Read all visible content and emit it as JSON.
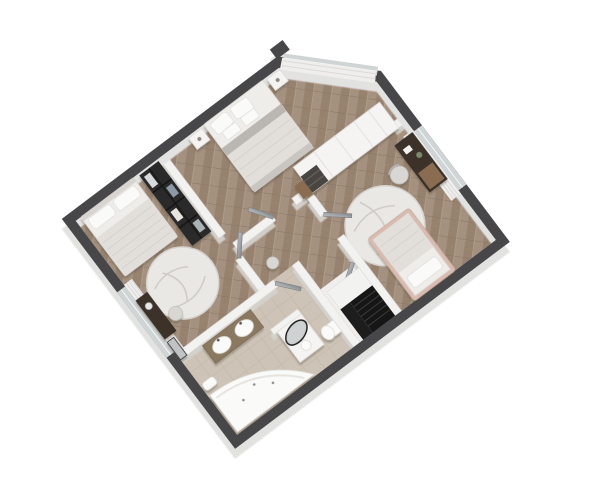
{
  "scene": {
    "type": "3d-floorplan-render",
    "description": "Isometric 3D render of an apartment upper floor on a white background, rotated about 37 degrees, dark grey wall tops, herringbone wood flooring, beige tiled bathroom",
    "rotation_deg": -37
  },
  "colors": {
    "background": "#ffffff",
    "wall_top": "#47474a",
    "wall_face": "#e6e6e5",
    "interior_wall": "#f2f2f1",
    "wood_floor": "#a5917f",
    "wood_floor_dark": "#97826f",
    "wood_floor_line": "#8a7666",
    "tile_floor": "#d0c6ba",
    "tile_line": "#c2b7a8",
    "rug": "#eae8e5",
    "bedding": "#efedea",
    "blanket": "#e2dfda",
    "stairs": "#161616",
    "black_wardrobe": "#2c2b29",
    "door": "#9aa0a3",
    "curtain": "#efeeed",
    "bathtub": "#fafaf9",
    "desk_dark": "#3c332b",
    "vanity_wood": "#8a7860",
    "bed_frame_pink": "#d9bcb0",
    "accent_wood": "#8a6d51"
  },
  "rooms": [
    {
      "name": "master-bedroom",
      "position": "top",
      "furniture": [
        "double-bed with grey throw and four pillows",
        "nightstand-left",
        "nightstand-right",
        "white-wardrobe-unit with open shelf",
        "curtains",
        "corner-windows"
      ]
    },
    {
      "name": "left-bedroom",
      "position": "left",
      "furniture": [
        "double-bed",
        "round-marble-rug",
        "open-black-metal-wardrobe with clothes",
        "dark-vanity-desk",
        "stool",
        "leaning-floor-mirror",
        "window-curtains"
      ]
    },
    {
      "name": "right-bedroom",
      "position": "right",
      "furniture": [
        "single-bed with pink frame",
        "round-marble-rug",
        "dark-desk with wood drawers",
        "desk-chair",
        "plant",
        "window-curtains"
      ]
    },
    {
      "name": "hallway",
      "position": "center",
      "furniture": [
        "door-to-master",
        "door-to-left-bedroom",
        "door-to-right-bedroom",
        "door-to-bathroom",
        "door-to-stairs",
        "round-stool"
      ]
    },
    {
      "name": "bathroom",
      "position": "bottom-left",
      "furniture": [
        "double-sink wood vanity",
        "island-unit with black-rimmed oval mirror",
        "corner-jacuzzi-bathtub",
        "wall-hung-toilet",
        "bidet",
        "toilet"
      ]
    },
    {
      "name": "staircase",
      "position": "bottom-right",
      "furniture": [
        "white-landing",
        "black-steps"
      ]
    }
  ],
  "floors": {
    "living_areas": "herringbone wood parquet",
    "bathroom": "beige stone tile"
  }
}
